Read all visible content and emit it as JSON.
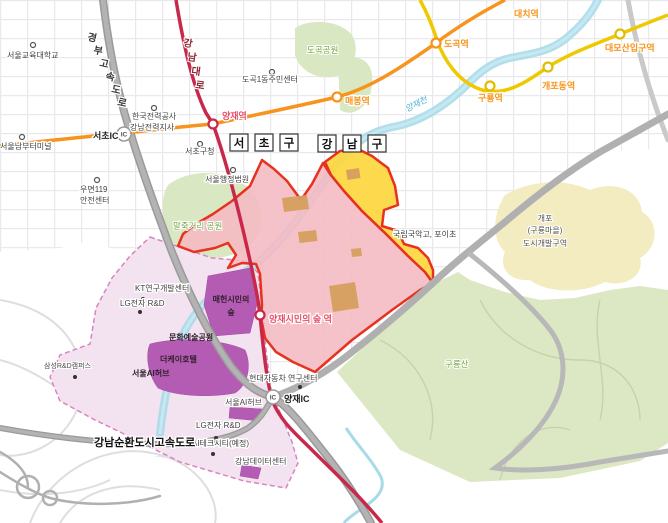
{
  "map": {
    "colors": {
      "zone_pink": "#f5b9c3",
      "zone_yellow": "#fdd73e",
      "zone_border_red": "#e6321e",
      "zone_lavender": "#f3e2ef",
      "lavender_dashed_border": "#d985c0",
      "facility_purple": "#b45cb4",
      "park_green": "#d9e8c2",
      "mountain_green": "#dce8c4",
      "dev_area_yellow": "#f2ecc0",
      "stream_blue": "#a8dbe8",
      "subway_line3_orange": "#f7941d",
      "subway_bundang_yellow": "#eec900",
      "subway_sinbundang_crimson": "#c8294b",
      "expressway_gray": "#9a9a9a",
      "building_tan": "#d7a05f"
    },
    "district_boxes": [
      {
        "id": "district-seocho",
        "chars": [
          "서",
          "초",
          "구"
        ],
        "cx": [
          239,
          264,
          289
        ],
        "cy": 147
      },
      {
        "id": "district-gangnam",
        "chars": [
          "강",
          "남",
          "구"
        ],
        "cx": [
          327,
          352,
          377
        ],
        "cy": 148
      }
    ],
    "stations": [
      {
        "id": "station-maebong",
        "line": "line3",
        "x": 337,
        "y": 97
      },
      {
        "id": "station-dogok",
        "line": "line3",
        "x": 436,
        "y": 43
      },
      {
        "id": "station-yangjae",
        "line": "sinbundang",
        "x": 213,
        "y": 124
      },
      {
        "id": "station-guryong",
        "line": "bundang",
        "x": 490,
        "y": 86
      },
      {
        "id": "station-gaepodong",
        "line": "bundang",
        "x": 548,
        "y": 67
      },
      {
        "id": "station-daemosan-ipgu",
        "line": "bundang",
        "x": 620,
        "y": 34
      },
      {
        "id": "station-yangjae-citizens-forest",
        "line": "sinbundang",
        "x": 260,
        "y": 315
      }
    ],
    "line_colors": {
      "line3": "#f7941d",
      "bundang": "#e0bd00",
      "sinbundang": "#c8294b"
    },
    "ic_badges": [
      {
        "id": "seocho-ic-badge",
        "label": "IC",
        "x": 124,
        "y": 134
      },
      {
        "id": "yangjae-ic-badge",
        "label": "IC",
        "x": 273,
        "y": 397
      }
    ],
    "dots": [
      {
        "x": 33,
        "y": 45,
        "t": "open"
      },
      {
        "x": 272,
        "y": 72,
        "t": "open"
      },
      {
        "x": 154,
        "y": 108,
        "t": "open"
      },
      {
        "x": 22,
        "y": 137,
        "t": "open"
      },
      {
        "x": 200,
        "y": 144,
        "t": "open"
      },
      {
        "x": 233,
        "y": 170,
        "t": "open"
      },
      {
        "x": 97,
        "y": 180,
        "t": "open"
      },
      {
        "x": 143,
        "y": 299,
        "t": "filled"
      },
      {
        "x": 140,
        "y": 312,
        "t": "filled"
      },
      {
        "x": 75,
        "y": 377,
        "t": "filled"
      },
      {
        "x": 300,
        "y": 387,
        "t": "filled"
      },
      {
        "x": 216,
        "y": 438,
        "t": "filled"
      },
      {
        "x": 213,
        "y": 454,
        "t": "filled"
      }
    ],
    "labels": [
      {
        "id": "label-seoul-edu-univ",
        "t": "서울교육대학교",
        "x": 7,
        "y": 58,
        "c": "poi"
      },
      {
        "id": "label-dogok1-center",
        "t": "도곡1동주민센터",
        "x": 242,
        "y": 82,
        "c": "poi"
      },
      {
        "id": "label-kepco-line1",
        "t": "한국전력공사",
        "x": 132,
        "y": 119,
        "c": "poi"
      },
      {
        "id": "label-kepco-line2",
        "t": "강남전력지사",
        "x": 130,
        "y": 130,
        "c": "poi"
      },
      {
        "id": "label-nambu-terminal",
        "t": "서울남부터미널",
        "x": 0,
        "y": 149,
        "c": "poi"
      },
      {
        "id": "label-seocho-gu-office",
        "t": "서초구청",
        "x": 185,
        "y": 154,
        "c": "poi"
      },
      {
        "id": "label-admin-court",
        "t": "서울행정법원",
        "x": 205,
        "y": 182,
        "c": "poi"
      },
      {
        "id": "label-umyeon119-line1",
        "t": "우면119",
        "x": 80,
        "y": 192,
        "c": "poi"
      },
      {
        "id": "label-umyeon119-line2",
        "t": "안전센터",
        "x": 80,
        "y": 203,
        "c": "poi"
      },
      {
        "id": "label-kt-rnd",
        "t": "KT연구개발센터",
        "x": 135,
        "y": 291,
        "c": "poi"
      },
      {
        "id": "label-lg-rnd-1",
        "t": "LG전자 R&D",
        "x": 120,
        "y": 306,
        "c": "poi"
      },
      {
        "id": "label-samsung-rnd",
        "t": "삼성R&D캠퍼스",
        "x": 44,
        "y": 368,
        "c": "poi-small"
      },
      {
        "id": "label-gugak-school",
        "t": "국립국악고, 포이초",
        "x": 393,
        "y": 237,
        "c": "poi"
      },
      {
        "id": "label-gaepo-dev-line1",
        "t": "개포",
        "x": 545,
        "y": 221,
        "c": "dev"
      },
      {
        "id": "label-gaepo-dev-line2",
        "t": "(구룡마을)",
        "x": 545,
        "y": 233,
        "c": "dev"
      },
      {
        "id": "label-gaepo-dev-line3",
        "t": "도시개발구역",
        "x": 545,
        "y": 246,
        "c": "dev"
      },
      {
        "id": "label-hyundai-rnd",
        "t": "현대자동차 연구센터",
        "x": 249,
        "y": 381,
        "c": "poi"
      },
      {
        "id": "label-seoul-ai-hub-1",
        "t": "서울AI허브",
        "x": 132,
        "y": 376,
        "c": "purple-poi"
      },
      {
        "id": "label-thek-hotel",
        "t": "더케이호텔",
        "x": 160,
        "y": 362,
        "c": "purple-poi"
      },
      {
        "id": "label-culture-arts-park",
        "t": "문화예술공원",
        "x": 169,
        "y": 340,
        "c": "purple-poi"
      },
      {
        "id": "label-maeheon-forest-line1",
        "t": "매헌시민의",
        "x": 231,
        "y": 302,
        "c": "purple-poi mid"
      },
      {
        "id": "label-maeheon-forest-line2",
        "t": "숲",
        "x": 231,
        "y": 315,
        "c": "purple-poi mid"
      },
      {
        "id": "label-seoul-ai-hub-2",
        "t": "서울AI허브",
        "x": 225,
        "y": 405,
        "c": "poi"
      },
      {
        "id": "label-lg-rnd-2",
        "t": "LG전자 R&D",
        "x": 196,
        "y": 428,
        "c": "poi"
      },
      {
        "id": "label-ai-tech-city",
        "t": "AI테크시티(예정)",
        "x": 192,
        "y": 446,
        "c": "poi"
      },
      {
        "id": "label-gangnam-datacenter",
        "t": "강남데이터센터",
        "x": 235,
        "y": 464,
        "c": "poi"
      },
      {
        "id": "label-gangnam-beltway",
        "t": "강남순환도시고속도로",
        "x": 94,
        "y": 446,
        "c": "road-bold"
      },
      {
        "id": "label-maljukgeori-park",
        "t": "말죽거리 공원",
        "x": 173,
        "y": 229,
        "c": "park"
      },
      {
        "id": "label-dogok-park",
        "t": "도곡공원",
        "x": 307,
        "y": 53,
        "c": "park"
      },
      {
        "id": "label-guryongsan",
        "t": "구룡산",
        "x": 445,
        "y": 367,
        "c": "park"
      },
      {
        "id": "label-yangjaecheon",
        "t": "양재천",
        "x": 407,
        "y": 112,
        "c": "stream-label",
        "r": -27
      },
      {
        "id": "label-gyeongbu-1",
        "t": "경",
        "x": 87,
        "y": 40,
        "c": "vert-road",
        "r": 12
      },
      {
        "id": "label-gyeongbu-2",
        "t": "부",
        "x": 93,
        "y": 53,
        "c": "vert-road",
        "r": 12
      },
      {
        "id": "label-gyeongbu-3",
        "t": "고",
        "x": 99,
        "y": 66,
        "c": "vert-road",
        "r": 12
      },
      {
        "id": "label-gyeongbu-4",
        "t": "속",
        "x": 105,
        "y": 79,
        "c": "vert-road",
        "r": 12
      },
      {
        "id": "label-gyeongbu-5",
        "t": "도",
        "x": 111,
        "y": 92,
        "c": "vert-road",
        "r": 12
      },
      {
        "id": "label-gyeongbu-6",
        "t": "로",
        "x": 117,
        "y": 105,
        "c": "vert-road",
        "r": 12
      },
      {
        "id": "label-gangnamdaero-1",
        "t": "강",
        "x": 183,
        "y": 46,
        "c": "road-red",
        "r": 8
      },
      {
        "id": "label-gangnamdaero-2",
        "t": "남",
        "x": 187,
        "y": 60,
        "c": "road-red",
        "r": 8
      },
      {
        "id": "label-gangnamdaero-3",
        "t": "대",
        "x": 191,
        "y": 74,
        "c": "road-red",
        "r": 8
      },
      {
        "id": "label-gangnamdaero-4",
        "t": "로",
        "x": 195,
        "y": 88,
        "c": "road-red",
        "r": 8
      },
      {
        "id": "label-station-maebong",
        "t": "매봉역",
        "x": 345,
        "y": 104,
        "c": "st-orange"
      },
      {
        "id": "label-station-dogok",
        "t": "도곡역",
        "x": 444,
        "y": 47,
        "c": "st-orange"
      },
      {
        "id": "label-station-daechi",
        "t": "대치역",
        "x": 514,
        "y": 17,
        "c": "st-orange"
      },
      {
        "id": "label-station-guryong",
        "t": "구룡역",
        "x": 478,
        "y": 101,
        "c": "st-orange"
      },
      {
        "id": "label-station-gaepodong",
        "t": "개포동역",
        "x": 542,
        "y": 89,
        "c": "st-orange"
      },
      {
        "id": "label-station-daemosan",
        "t": "대모산입구역",
        "x": 605,
        "y": 51,
        "c": "st-orange"
      },
      {
        "id": "label-station-yangjae",
        "t": "양재역",
        "x": 222,
        "y": 119,
        "c": "st-red"
      },
      {
        "id": "label-station-ycf",
        "t": "양재시민의 숲 역",
        "x": 269,
        "y": 322,
        "c": "st-red"
      },
      {
        "id": "label-seocho-ic",
        "t": "서초IC",
        "x": 93,
        "y": 139,
        "c": "ic-label"
      },
      {
        "id": "label-yangjae-ic",
        "t": "양재IC",
        "x": 284,
        "y": 402,
        "c": "ic-label"
      }
    ]
  }
}
